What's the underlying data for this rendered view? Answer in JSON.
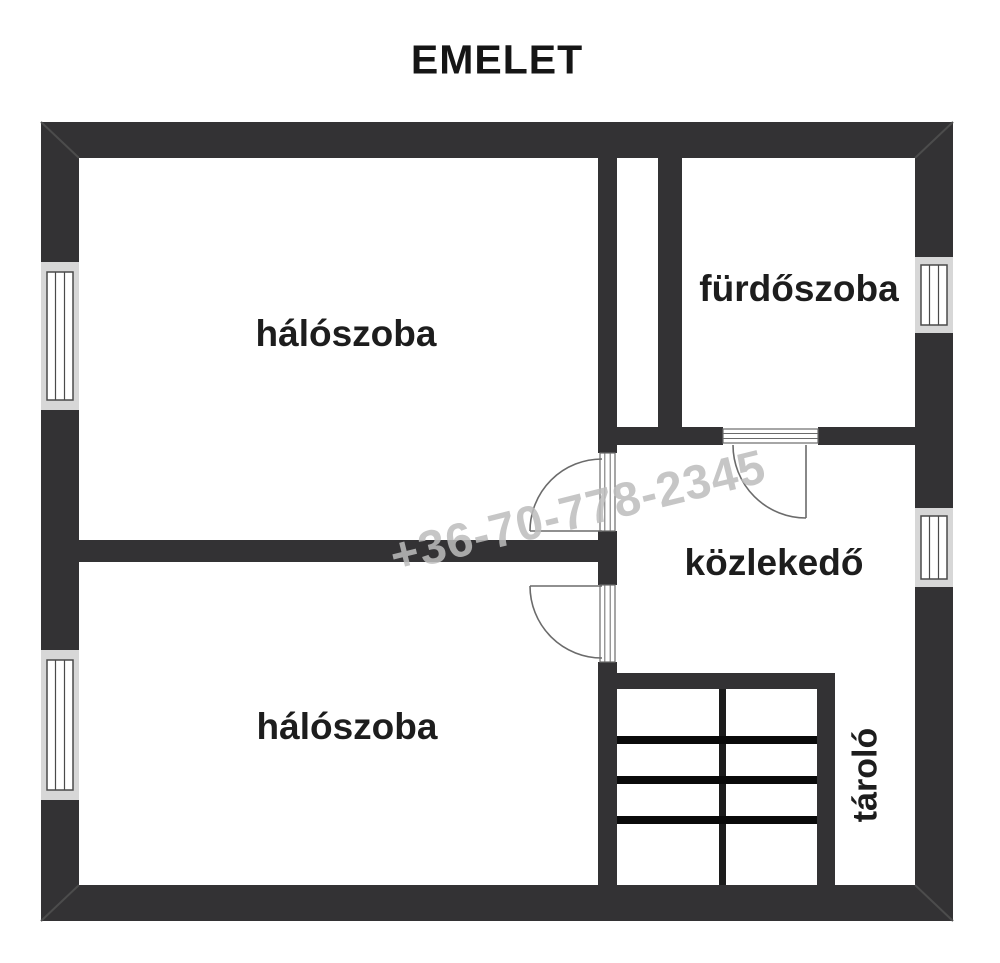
{
  "title": "EMELET",
  "watermark": {
    "text": "+36-70-778-2345"
  },
  "rooms": [
    {
      "id": "bedroom-upper",
      "label": "hálószoba"
    },
    {
      "id": "bathroom",
      "label": "fürdőszoba"
    },
    {
      "id": "hallway",
      "label": "közlekedő"
    },
    {
      "id": "bedroom-lower",
      "label": "hálószoba"
    },
    {
      "id": "storage",
      "label": "tároló"
    }
  ],
  "colors": {
    "background": "#ffffff",
    "wall": "#333234",
    "stair_tread": "#0a0a0a",
    "divider": "#1c1c1c",
    "bevel": "#4c4c4c",
    "line": "#6b6b6b",
    "window_bg": "#d7d7d7",
    "window_line": "#4a4a4a",
    "label_text": "#1d1d1d",
    "watermark": "#bdbdbd"
  }
}
